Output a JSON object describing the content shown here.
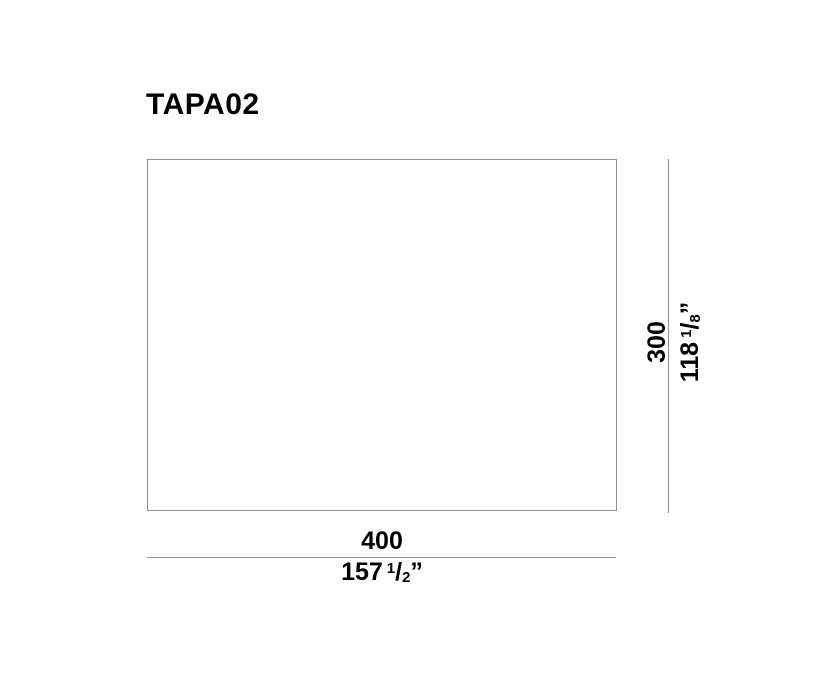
{
  "title": "TAPA02",
  "colors": {
    "background": "#ffffff",
    "dimension_line": "#8f8f8f",
    "text": "#000000"
  },
  "dimensions": {
    "width": {
      "metric": "400",
      "imperial": {
        "whole": "157",
        "numerator": "1",
        "separator": "/",
        "denominator": "2",
        "unit_mark": "”"
      }
    },
    "height": {
      "metric": "300",
      "imperial": {
        "whole": "118",
        "numerator": "1",
        "separator": "/",
        "denominator": "8",
        "unit_mark": "”"
      }
    }
  }
}
